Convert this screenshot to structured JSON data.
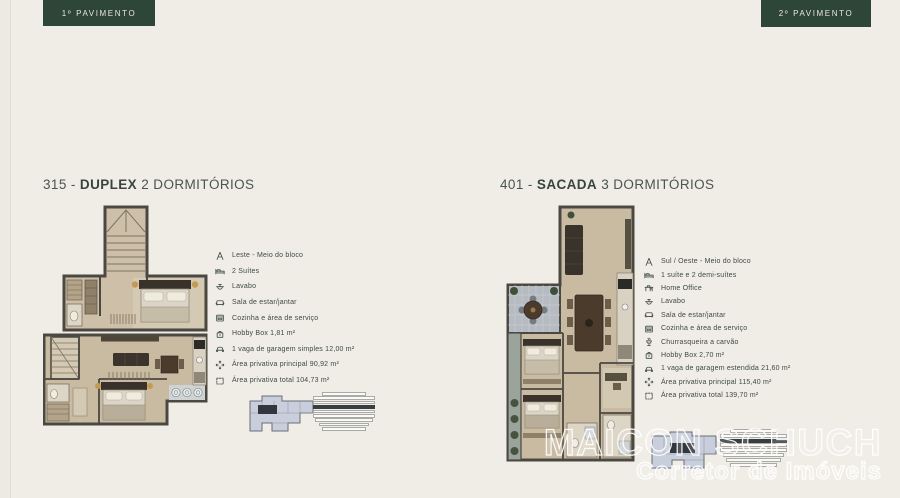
{
  "page": {
    "background": "#f0ede7",
    "accent_green": "#2d4637",
    "text_green": "#3e4a42"
  },
  "floor_tags": {
    "left": "1º PAVIMENTO",
    "right": "2º PAVIMENTO"
  },
  "left_unit": {
    "title": {
      "number": "315 - ",
      "bold": "DUPLEX",
      "rest": " 2 DORMITÓRIOS"
    },
    "features": [
      {
        "icon": "compass",
        "text": "Leste - Meio do bloco"
      },
      {
        "icon": "bed",
        "text": "2 Suítes"
      },
      {
        "icon": "sink",
        "text": "Lavabo"
      },
      {
        "icon": "sofa",
        "text": "Sala de estar/jantar"
      },
      {
        "icon": "kitchen",
        "text": "Cozinha e área de serviço"
      },
      {
        "icon": "hobby-box",
        "text": "Hobby Box 1,81 m²"
      },
      {
        "icon": "car",
        "text": "1 vaga de garagem simples 12,00 m²"
      },
      {
        "icon": "expand",
        "text": "Área privativa principal 90,92 m²"
      },
      {
        "icon": "area",
        "text": "Área privativa total 104,73 m²"
      }
    ],
    "level_indicator": {
      "rows": 9,
      "highlighted_row": 4
    }
  },
  "right_unit": {
    "title": {
      "number": "401 - ",
      "bold": "SACADA",
      "rest": " 3 DORMITÓRIOS"
    },
    "features": [
      {
        "icon": "compass",
        "text": "Sul / Oeste - Meio do bloco"
      },
      {
        "icon": "bed",
        "text": "1 suíte e 2 demi-suítes"
      },
      {
        "icon": "desk",
        "text": "Home Office"
      },
      {
        "icon": "sink",
        "text": "Lavabo"
      },
      {
        "icon": "sofa",
        "text": "Sala de estar/jantar"
      },
      {
        "icon": "kitchen",
        "text": "Cozinha e área de serviço"
      },
      {
        "icon": "grill",
        "text": "Churrasqueira a carvão"
      },
      {
        "icon": "hobby-box",
        "text": "Hobby Box 2,70 m²"
      },
      {
        "icon": "car",
        "text": "1 vaga de garagem estendida 21,60 m²"
      },
      {
        "icon": "expand",
        "text": "Área privativa principal 115,40 m²"
      },
      {
        "icon": "area",
        "text": "Área privativa total 139,70 m²"
      }
    ],
    "level_indicator": {
      "rows": 8,
      "highlighted_row": 3
    }
  },
  "watermark": {
    "line1": "MAICON SCHUCH",
    "line2": "Corretor de Imóveis"
  }
}
